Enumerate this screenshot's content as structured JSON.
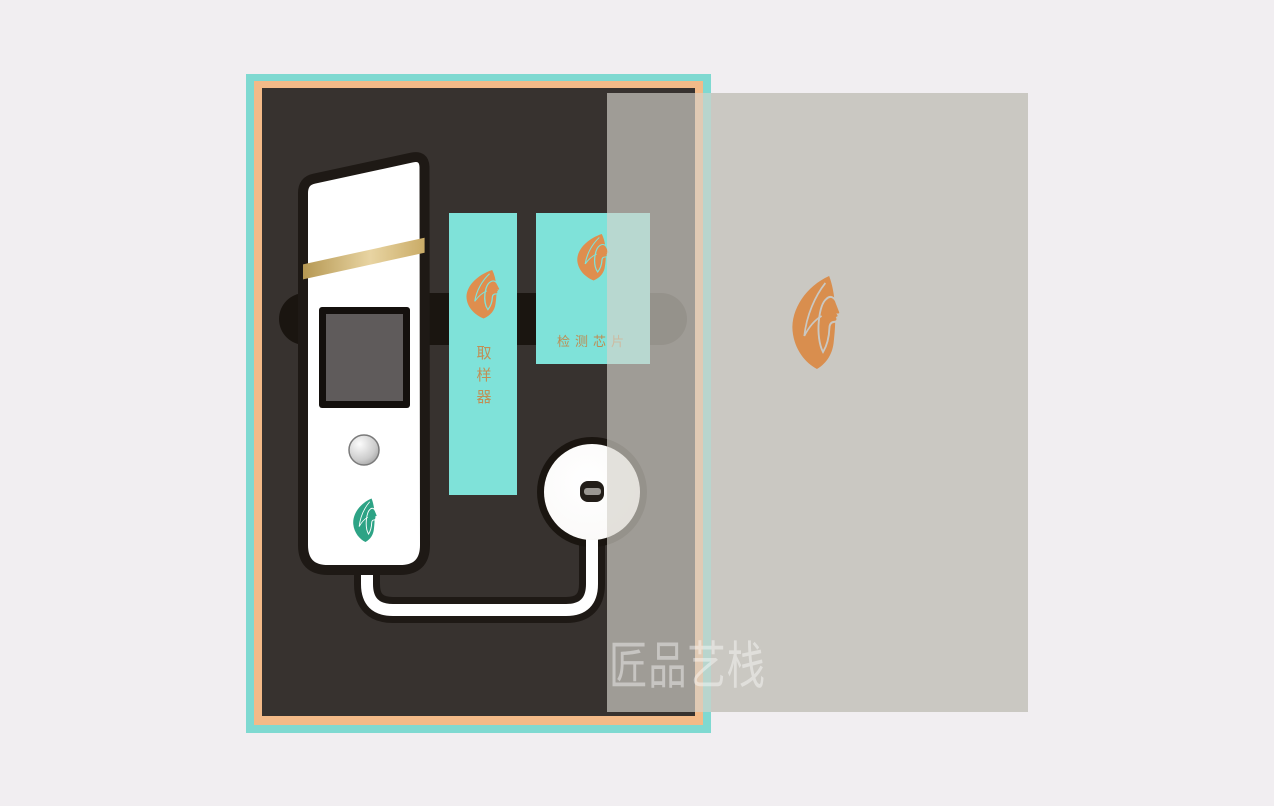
{
  "scene": {
    "description": "skin-tester device packaging box mockup with translucent sliding lid"
  },
  "cards": {
    "sampler": {
      "label": "取样器"
    },
    "chip": {
      "label": "检测芯片"
    }
  },
  "watermark": {
    "text": "匠品艺栈"
  },
  "icons": {
    "brand_logo": "leaf-face-woman-profile"
  },
  "colors": {
    "background": "#f1eef1",
    "box_border_teal": "#7fd9d1",
    "box_border_orange": "#f3ba88",
    "box_interior": "#37322f",
    "foam_recess": "#1a1510",
    "card_teal": "#7fe2d9",
    "logo_orange": "#df8e4e",
    "logo_green": "#2da385",
    "label_orange": "#c08f55",
    "gold_stripe": "#cbaf6a",
    "lid_gray": "#cac8c2",
    "device_white": "#ffffff"
  }
}
